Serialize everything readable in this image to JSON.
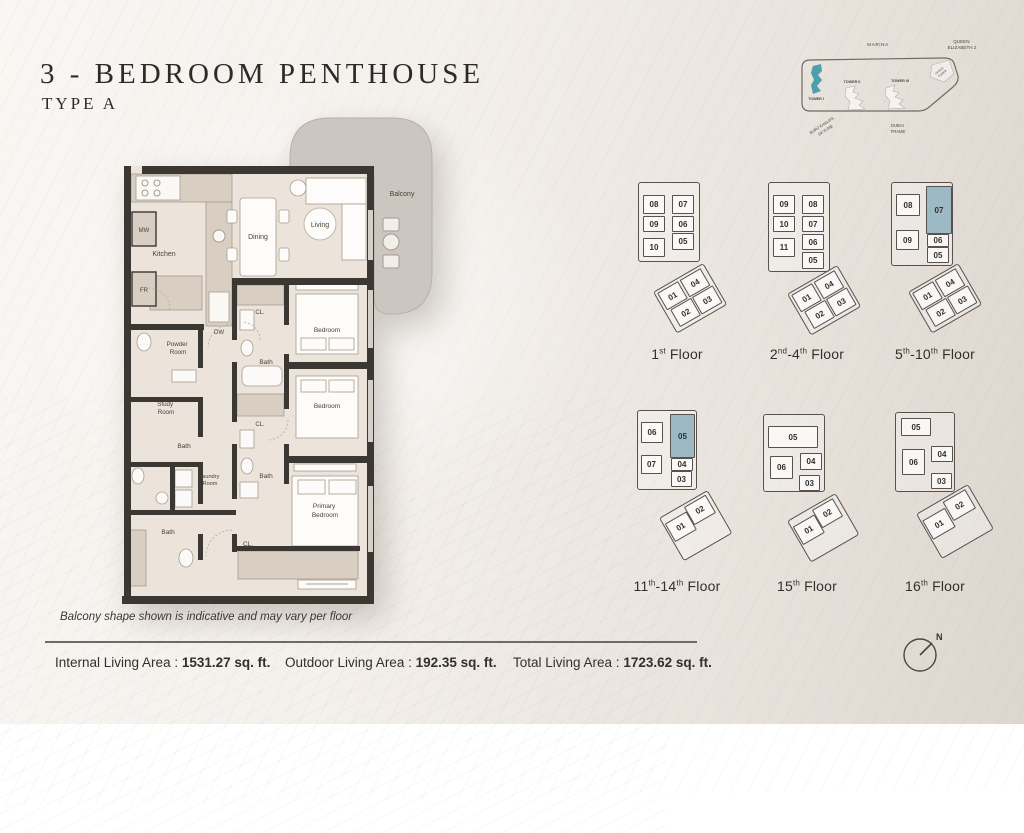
{
  "title": "3 - BEDROOM PENTHOUSE",
  "subtitle": "TYPE A",
  "colors": {
    "wall": "#3b3733",
    "floor": "#ece4da",
    "balcony": "#cdc5c0",
    "closet_beige": "#d9cec2",
    "tower_highlight": "#4e9fae",
    "unit_highlight": "#9db9c3"
  },
  "site_map": {
    "marina": "MARINA",
    "queen_1": "QUEEN",
    "queen_2": "ELIZABETH 2",
    "tower1": "TOWER I",
    "tower2": "TOWER II",
    "tower3": "TOWER III",
    "office_1": "OFFICE",
    "office_2": "TOWER",
    "burj_1": "BURJ KHALIFA",
    "burj_2": "SKYLINE",
    "dubai_1": "DUBAI",
    "dubai_2": "FRAME"
  },
  "floor_plan": {
    "labels": {
      "kitchen": "Kitchen",
      "mw": "MW",
      "fr": "FR",
      "dw": "DW",
      "dining": "Dining",
      "living": "Living",
      "balcony": "Balcony",
      "bedroom": "Bedroom",
      "primary_1": "Primary",
      "primary_2": "Bedroom",
      "bath": "Bath",
      "closet": "CL.",
      "powder_1": "Powder",
      "powder_2": "Room",
      "study_1": "Study",
      "study_2": "Room",
      "laundry_1": "Laundry",
      "laundry_2": "Room"
    }
  },
  "key_plans": {
    "plans": [
      {
        "label": "1st Floor",
        "pos": {
          "x": 612,
          "y": 170
        },
        "outline": {
          "x": 26,
          "y": 12,
          "w": 60,
          "h": 78
        },
        "units": [
          {
            "n": "08",
            "x": 31,
            "y": 25,
            "w": 20,
            "h": 17
          },
          {
            "n": "07",
            "x": 60,
            "y": 25,
            "w": 20,
            "h": 17
          },
          {
            "n": "09",
            "x": 31,
            "y": 46,
            "w": 20,
            "h": 14
          },
          {
            "n": "06",
            "x": 60,
            "y": 46,
            "w": 20,
            "h": 14
          },
          {
            "n": "10",
            "x": 31,
            "y": 68,
            "w": 20,
            "h": 17
          },
          {
            "n": "05",
            "x": 60,
            "y": 63,
            "w": 20,
            "h": 15
          }
        ],
        "lower": {
          "x": 41,
          "y": 122,
          "rot": -30,
          "w": 56,
          "h": 46,
          "units": [
            {
              "n": "01",
              "x": 2,
              "y": 2,
              "w": 22,
              "h": 18
            },
            {
              "n": "04",
              "x": 28,
              "y": 2,
              "w": 22,
              "h": 18
            },
            {
              "n": "02",
              "x": 5,
              "y": 23,
              "w": 22,
              "h": 18
            },
            {
              "n": "03",
              "x": 30,
              "y": 23,
              "w": 22,
              "h": 18
            }
          ]
        }
      },
      {
        "label": "2nd-4th Floor",
        "pos": {
          "x": 742,
          "y": 170
        },
        "outline": {
          "x": 26,
          "y": 12,
          "w": 60,
          "h": 88
        },
        "units": [
          {
            "n": "09",
            "x": 31,
            "y": 25,
            "w": 20,
            "h": 17
          },
          {
            "n": "08",
            "x": 60,
            "y": 25,
            "w": 20,
            "h": 17
          },
          {
            "n": "10",
            "x": 31,
            "y": 46,
            "w": 20,
            "h": 14
          },
          {
            "n": "07",
            "x": 60,
            "y": 46,
            "w": 20,
            "h": 14
          },
          {
            "n": "11",
            "x": 31,
            "y": 68,
            "w": 20,
            "h": 17
          },
          {
            "n": "06",
            "x": 60,
            "y": 64,
            "w": 20,
            "h": 14
          },
          {
            "n": "05",
            "x": 60,
            "y": 82,
            "w": 20,
            "h": 15
          }
        ],
        "lower": {
          "x": 45,
          "y": 124,
          "rot": -30,
          "w": 56,
          "h": 46,
          "units": [
            {
              "n": "01",
              "x": 2,
              "y": 2,
              "w": 22,
              "h": 18
            },
            {
              "n": "04",
              "x": 28,
              "y": 2,
              "w": 22,
              "h": 18
            },
            {
              "n": "02",
              "x": 5,
              "y": 23,
              "w": 22,
              "h": 18
            },
            {
              "n": "03",
              "x": 30,
              "y": 23,
              "w": 22,
              "h": 18
            }
          ]
        }
      },
      {
        "label": "5th-10th Floor",
        "pos": {
          "x": 870,
          "y": 170
        },
        "outline": {
          "x": 21,
          "y": 12,
          "w": 60,
          "h": 82
        },
        "units": [
          {
            "n": "08",
            "x": 26,
            "y": 24,
            "w": 22,
            "h": 20
          },
          {
            "n": "07",
            "x": 56,
            "y": 16,
            "w": 24,
            "h": 46,
            "hl": true
          },
          {
            "n": "09",
            "x": 26,
            "y": 60,
            "w": 21,
            "h": 18
          },
          {
            "n": "06",
            "x": 57,
            "y": 64,
            "w": 20,
            "h": 11
          },
          {
            "n": "05",
            "x": 57,
            "y": 77,
            "w": 20,
            "h": 14
          }
        ],
        "lower": {
          "x": 38,
          "y": 122,
          "rot": -30,
          "w": 56,
          "h": 46,
          "units": [
            {
              "n": "01",
              "x": 2,
              "y": 2,
              "w": 22,
              "h": 18
            },
            {
              "n": "04",
              "x": 28,
              "y": 2,
              "w": 22,
              "h": 18
            },
            {
              "n": "02",
              "x": 5,
              "y": 23,
              "w": 22,
              "h": 18
            },
            {
              "n": "03",
              "x": 30,
              "y": 23,
              "w": 22,
              "h": 18
            }
          ]
        }
      },
      {
        "label": "11th-14th Floor",
        "pos": {
          "x": 612,
          "y": 402
        },
        "outline": {
          "x": 25,
          "y": 8,
          "w": 58,
          "h": 78
        },
        "units": [
          {
            "n": "06",
            "x": 29,
            "y": 20,
            "w": 20,
            "h": 19
          },
          {
            "n": "05",
            "x": 58,
            "y": 12,
            "w": 23,
            "h": 42,
            "hl": true
          },
          {
            "n": "07",
            "x": 29,
            "y": 53,
            "w": 19,
            "h": 17
          },
          {
            "n": "04",
            "x": 59,
            "y": 56,
            "w": 20,
            "h": 11
          },
          {
            "n": "03",
            "x": 59,
            "y": 69,
            "w": 19,
            "h": 14
          }
        ],
        "lower": {
          "x": 47,
          "y": 116,
          "rot": -30,
          "w": 54,
          "h": 48,
          "units": [
            {
              "n": "02",
              "x": 26,
              "y": 2,
              "w": 23,
              "h": 19
            },
            {
              "n": "01",
              "x": 1,
              "y": 7,
              "w": 23,
              "h": 19
            }
          ]
        }
      },
      {
        "label": "15th Floor",
        "pos": {
          "x": 742,
          "y": 402
        },
        "outline": {
          "x": 21,
          "y": 12,
          "w": 60,
          "h": 76
        },
        "units": [
          {
            "n": "05",
            "x": 26,
            "y": 24,
            "w": 48,
            "h": 20
          },
          {
            "n": "06",
            "x": 28,
            "y": 54,
            "w": 21,
            "h": 21
          },
          {
            "n": "04",
            "x": 58,
            "y": 51,
            "w": 20,
            "h": 15
          },
          {
            "n": "03",
            "x": 57,
            "y": 73,
            "w": 19,
            "h": 14
          }
        ],
        "lower": {
          "x": 45,
          "y": 119,
          "rot": -30,
          "w": 54,
          "h": 46,
          "units": [
            {
              "n": "02",
              "x": 26,
              "y": 2,
              "w": 22,
              "h": 19
            },
            {
              "n": "01",
              "x": 1,
              "y": 7,
              "w": 23,
              "h": 19
            }
          ]
        }
      },
      {
        "label": "16th Floor",
        "pos": {
          "x": 870,
          "y": 402
        },
        "outline": {
          "x": 25,
          "y": 10,
          "w": 58,
          "h": 78
        },
        "units": [
          {
            "n": "05",
            "x": 31,
            "y": 16,
            "w": 28,
            "h": 16
          },
          {
            "n": "06",
            "x": 32,
            "y": 47,
            "w": 21,
            "h": 24
          },
          {
            "n": "04",
            "x": 61,
            "y": 44,
            "w": 20,
            "h": 14
          },
          {
            "n": "03",
            "x": 61,
            "y": 71,
            "w": 19,
            "h": 14
          }
        ],
        "lower": {
          "x": 46,
          "y": 112,
          "rot": -30,
          "w": 58,
          "h": 50,
          "units": [
            {
              "n": "02",
              "x": 28,
              "y": 2,
              "w": 24,
              "h": 20
            },
            {
              "n": "01",
              "x": 1,
              "y": 8,
              "w": 24,
              "h": 20
            }
          ]
        }
      }
    ]
  },
  "note": "Balcony shape shown is indicative and may vary per floor",
  "areas": {
    "internal_label": "Internal Living Area : ",
    "internal_value": "1531.27 sq. ft.",
    "outdoor_label": "Outdoor Living Area : ",
    "outdoor_value": "192.35 sq. ft.",
    "total_label": "Total Living Area : ",
    "total_value": "1723.62 sq. ft."
  },
  "compass": {
    "north": "N"
  }
}
